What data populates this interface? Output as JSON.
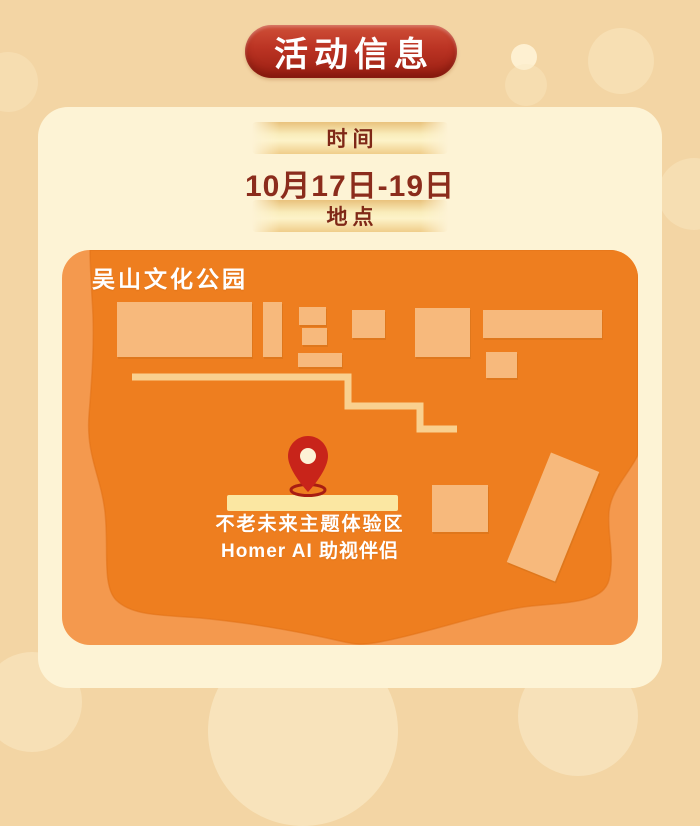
{
  "title_badge": {
    "label": "活动信息"
  },
  "info_card": {
    "time_label": "时间",
    "time_value": "10月17日-19日",
    "location_label": "地点"
  },
  "map": {
    "title": "吴山文化公园",
    "venue_line1": "不老未来主题体验区",
    "venue_line2": "Homer AI 助视伴侣"
  },
  "colors": {
    "page_background": "#f3d5a4",
    "card_background": "#fdf3d5",
    "badge_red_top": "#cf5038",
    "badge_red_bottom": "#9a1f12",
    "gold_bar": "#f9ecba",
    "maroon_text": "#8b2c1c",
    "map_base_orange": "#f4994e",
    "map_blob_orange": "#ee7e1f",
    "building_peach": "#f7b97c",
    "path_gold": "#f9d08f",
    "highlight_strip": "#fbe7a2",
    "pin_red": "#c8241a"
  }
}
